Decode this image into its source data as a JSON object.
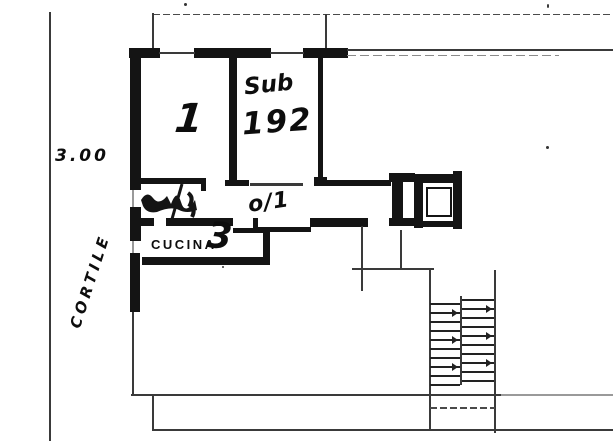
{
  "meta": {
    "document_type": "hand-drawn cadastral floor plan sketch"
  },
  "colors": {
    "ink": "#141414",
    "faint_line": "#9a9a9a",
    "paper": "#ffffff"
  },
  "annotations": {
    "dimension": "3.00",
    "courtyard": "CORTILE",
    "room_number": "1",
    "sub_label": "Sub",
    "sub_number": "192",
    "kitchen_label": "CUCINA",
    "kitchen_number": "3",
    "corridor_mark": "o/1"
  },
  "drawings": [
    "bathroom-fixture-scribble",
    "staircase",
    "elevator-shaft"
  ],
  "stairs": {
    "flights": 2,
    "treads_per_flight": 10
  }
}
